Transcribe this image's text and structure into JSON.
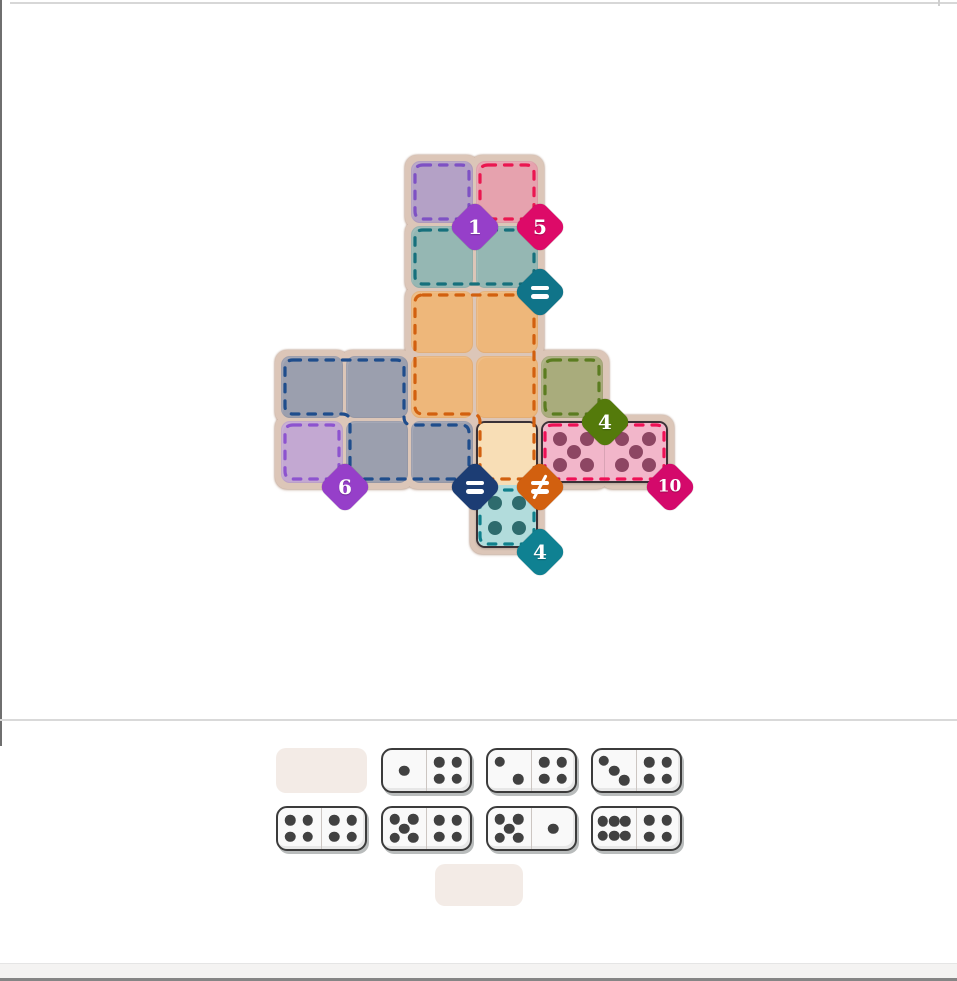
{
  "title": "domino puzzle board",
  "board": {
    "grid": {
      "rows": 6,
      "cols": 6
    },
    "regions": [
      {
        "id": "A",
        "name": "purple-top",
        "cells": [
          [
            0,
            2
          ]
        ],
        "fill": "#b4a1c6",
        "dash": "#7e51c4",
        "badge": {
          "label": "1",
          "color": "#963fc9",
          "cell": [
            0,
            2
          ]
        }
      },
      {
        "id": "B",
        "name": "red-top",
        "cells": [
          [
            0,
            3
          ]
        ],
        "fill": "#e6a2ae",
        "dash": "#ea1750",
        "badge": {
          "label": "5",
          "color": "#dd0a68",
          "cell": [
            0,
            3
          ]
        }
      },
      {
        "id": "C",
        "name": "teal-pair",
        "cells": [
          [
            1,
            2
          ],
          [
            1,
            3
          ]
        ],
        "fill": "#95b7b3",
        "dash": "#16707c",
        "badge": {
          "label": "=",
          "color": "#107489",
          "cell": [
            1,
            3
          ]
        }
      },
      {
        "id": "D",
        "name": "orange-pentomino",
        "cells": [
          [
            2,
            2
          ],
          [
            2,
            3
          ],
          [
            3,
            2
          ],
          [
            3,
            3
          ],
          [
            4,
            3
          ]
        ],
        "fill": "#eeb77a",
        "dash": "#d2600f",
        "badge": {
          "label": "≠",
          "color": "#d2600f",
          "cell": [
            4,
            3
          ]
        },
        "path": "M423 295H526Q534 295 534 303V471Q534 479 526 479H488Q480 479 480 471V422Q480 414 472 414H423Q415 414 415 406V303Q415 295 423 295Z"
      },
      {
        "id": "E",
        "name": "navy-tetromino",
        "cells": [
          [
            3,
            0
          ],
          [
            3,
            1
          ],
          [
            4,
            1
          ],
          [
            4,
            2
          ]
        ],
        "fill": "#9b9fae",
        "dash": "#1f4d8c",
        "badge": {
          "label": "=",
          "color": "#1c3d74",
          "cell": [
            4,
            2
          ]
        },
        "path": "M293 360H396Q404 360 404 368V417Q404 425 412 425H461Q469 425 469 433V471Q469 479 461 479H358Q350 479 350 471V422Q350 414 342 414H293Q285 414 285 406V368Q285 360 293 360Z"
      },
      {
        "id": "F",
        "name": "purple-single",
        "cells": [
          [
            4,
            0
          ]
        ],
        "fill": "#c3a8d2",
        "dash": "#8d53cf",
        "badge": {
          "label": "6",
          "color": "#963fc9",
          "cell": [
            4,
            0
          ]
        }
      },
      {
        "id": "G",
        "name": "green-single",
        "cells": [
          [
            3,
            4
          ]
        ],
        "fill": "#a9ac7c",
        "dash": "#5b7c20",
        "badge": {
          "label": "4",
          "color": "#547a0b",
          "cell": [
            3,
            4
          ]
        }
      },
      {
        "id": "H",
        "name": "pink-pair",
        "cells": [
          [
            4,
            4
          ],
          [
            4,
            5
          ]
        ],
        "fill": "#f2b6ca",
        "dash": "#ee1156",
        "badge": {
          "label": "10",
          "color": "#d4096b",
          "cell": [
            4,
            5
          ]
        }
      },
      {
        "id": "I",
        "name": "teal-single",
        "cells": [
          [
            5,
            3
          ]
        ],
        "fill": "#b2dcdc",
        "dash": "#0f808c",
        "badge": {
          "label": "4",
          "color": "#0f8192",
          "cell": [
            5,
            3
          ]
        }
      }
    ],
    "placed_dominoes": [
      {
        "name": "domino-5-5",
        "cells": [
          [
            4,
            4
          ],
          [
            4,
            5
          ]
        ],
        "pips": [
          5,
          5
        ],
        "half_fills": [
          "#f2b6ca",
          "#f2b6ca"
        ],
        "pip_color": "#8d4663",
        "divider": true
      },
      {
        "name": "domino-0-4",
        "cells": [
          [
            4,
            3
          ],
          [
            5,
            3
          ]
        ],
        "pips": [
          0,
          4
        ],
        "half_fills": [
          "#f8deb6",
          "#b2dcdc"
        ],
        "pip_color": "#2e6b6d",
        "divider": false
      }
    ]
  },
  "tray": {
    "pip_color": "#414141",
    "rows": [
      [
        {
          "type": "slot"
        },
        {
          "type": "domino",
          "pips": [
            1,
            4
          ]
        },
        {
          "type": "domino",
          "pips": [
            2,
            4
          ]
        },
        {
          "type": "domino",
          "pips": [
            3,
            4
          ]
        }
      ],
      [
        {
          "type": "domino",
          "pips": [
            4,
            4
          ]
        },
        {
          "type": "domino",
          "pips": [
            5,
            4
          ]
        },
        {
          "type": "domino",
          "pips": [
            5,
            1
          ]
        },
        {
          "type": "domino",
          "pips": [
            6,
            4
          ]
        }
      ],
      [
        {
          "type": "slot-small"
        }
      ]
    ]
  }
}
